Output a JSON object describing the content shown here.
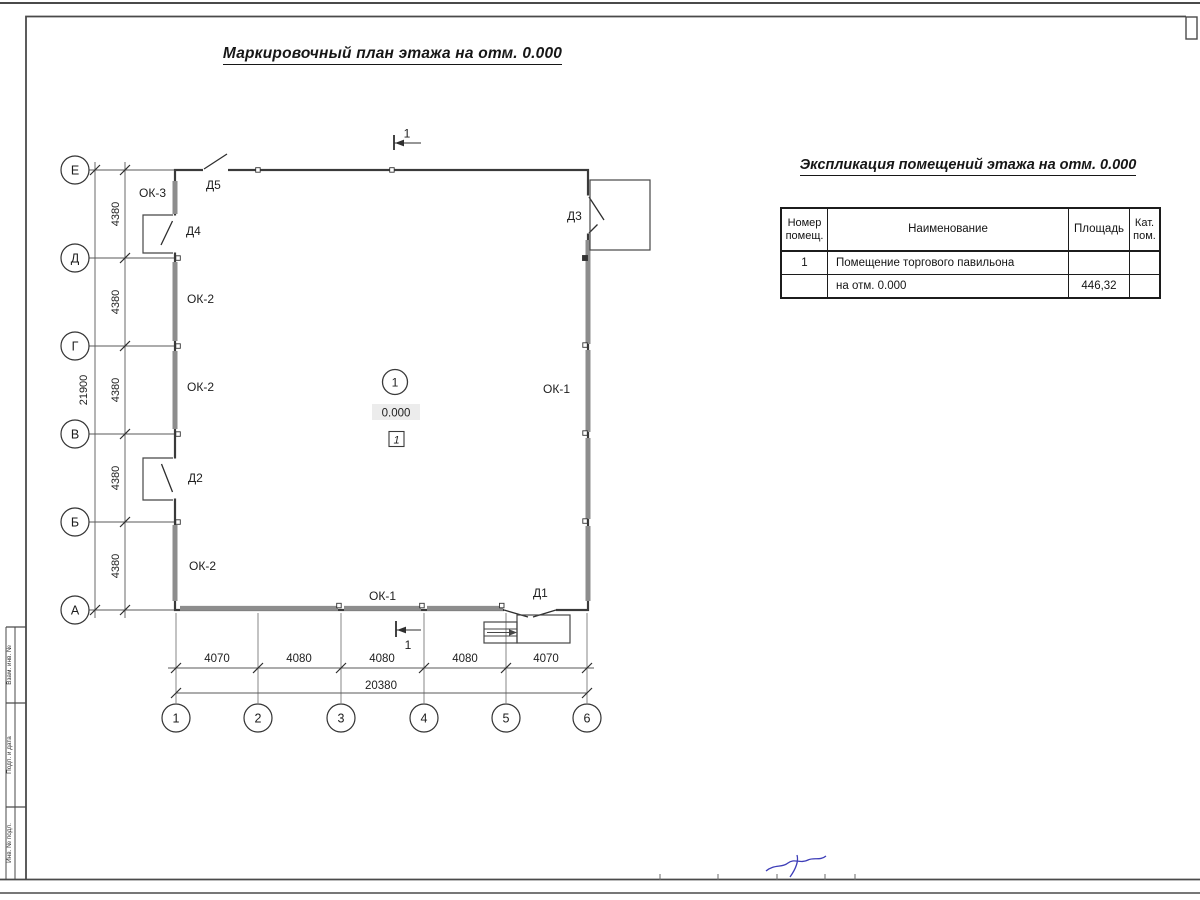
{
  "sheet": {
    "title": "Маркировочный план этажа на отм. 0.000"
  },
  "explication": {
    "title": "Экспликация помещений этажа на отм. 0.000",
    "headers": {
      "num": [
        "Номер",
        "помещ."
      ],
      "name": "Наименование",
      "area": "Площадь",
      "cat": [
        "Кат.",
        "пом."
      ]
    },
    "rows": [
      {
        "num": "1",
        "name": "Помещение торгового павильона",
        "area": "",
        "cat": ""
      },
      {
        "num": "",
        "name": "на отм. 0.000",
        "area": "446,32",
        "cat": ""
      }
    ]
  },
  "plan": {
    "row_axes": [
      "Е",
      "Д",
      "Г",
      "В",
      "Б",
      "А"
    ],
    "col_axes": [
      "1",
      "2",
      "3",
      "4",
      "5",
      "6"
    ],
    "v_dims": [
      "4380",
      "4380",
      "4380",
      "4380",
      "4380"
    ],
    "v_total": "21900",
    "h_dims": [
      "4070",
      "4080",
      "4080",
      "4080",
      "4070"
    ],
    "h_total": "20380",
    "windows": {
      "ok1": "ОК-1",
      "ok2": "ОК-2",
      "ok3": "ОК-3"
    },
    "doors": {
      "d1": "Д1",
      "d2": "Д2",
      "d3": "Д3",
      "d4": "Д4",
      "d5": "Д5"
    },
    "room": {
      "number": "1",
      "level": "0.000",
      "finish": "1"
    },
    "section": "1"
  },
  "frame": {
    "stamp_labels": [
      "Взам. инв. №",
      "Подп. и дата",
      "Инв. № подл."
    ]
  },
  "colors": {
    "line": "#3a3a3a",
    "window_band": "#8d8d8d",
    "signature_blue": "#3d3db8"
  }
}
